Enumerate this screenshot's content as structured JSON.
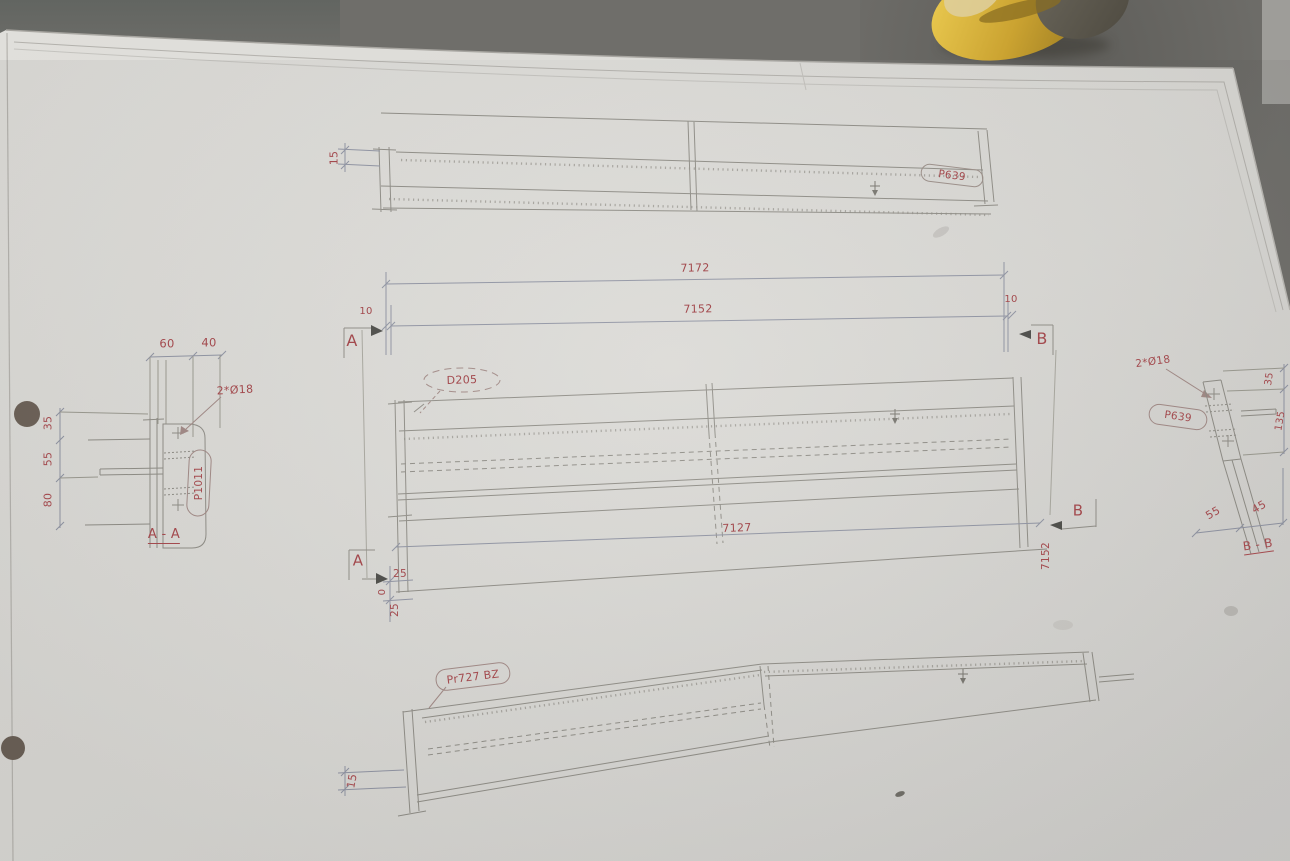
{
  "scene": {
    "description": "Photo of a structural steel shop drawing on paper lying on a concrete floor",
    "paper_color": "#dcdbd7",
    "concrete_color": "#6f6e6a",
    "line_color": "#8e8c85",
    "dim_line_color": "#8f93a2",
    "accent_red": "#a34a4e",
    "yellow_object_color": "#d3a837"
  },
  "top_beam": {
    "dim_left": "15",
    "part_label": "P639"
  },
  "length_dims": {
    "overall": "7172",
    "inner": "7152",
    "left_offset": "10",
    "right_offset": "10",
    "section_left": "A",
    "section_right": "B"
  },
  "section_aa": {
    "title": "A - A",
    "dim_top_1": "60",
    "dim_top_2": "40",
    "hole_note": "2*Ø18",
    "dim_v1": "35",
    "dim_v2": "55",
    "dim_v3": "80",
    "part_label": "P1011"
  },
  "mid_beam": {
    "part_label": "D205",
    "dim_bottom": "7127",
    "dim_right_vertical": "7152",
    "section_right": "B",
    "section_left": "A",
    "dim_offset_top": "25",
    "dim_offset_zero": "0",
    "dim_offset_bottom": "25"
  },
  "section_bb": {
    "title": "B - B",
    "hole_note": "2*Ø18",
    "part_label": "P639",
    "dim_r1": "35",
    "dim_r2": "135",
    "dim_b1": "55",
    "dim_b2": "45"
  },
  "bottom_beam": {
    "part_label": "Pr727 BZ",
    "dim_left": "15"
  }
}
